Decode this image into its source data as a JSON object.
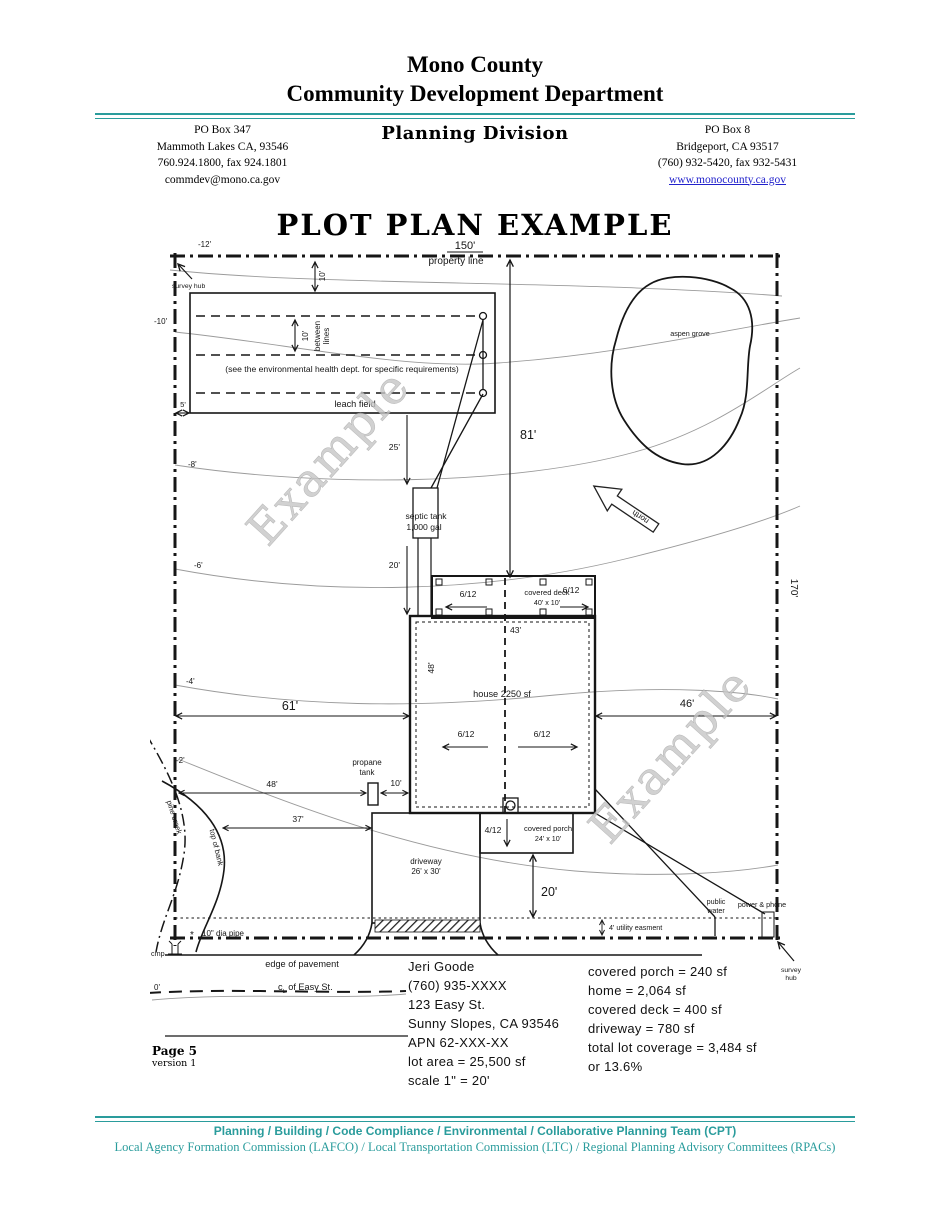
{
  "header": {
    "org_line1": "Mono County",
    "org_line2": "Community Development Department",
    "division": "Planning Division",
    "left_address": [
      "PO Box 347",
      "Mammoth Lakes CA, 93546",
      "760.924.1800, fax 924.1801",
      "commdev@mono.ca.gov"
    ],
    "right_address": [
      "PO Box 8",
      "Bridgeport, CA  93517",
      "(760) 932-5420, fax 932-5431"
    ],
    "website": "www.monocounty.ca.gov"
  },
  "page_title": "PLOT PLAN EXAMPLE",
  "plot": {
    "labels": {
      "survey_hub": "survey hub",
      "survey_1": "survey",
      "survey_2": "hub",
      "dim_150": "150'",
      "property_line": "property line",
      "dim_170": "170'",
      "contour_m12": "-12'",
      "contour_m10": "-10'",
      "contour_m8": "-8'",
      "contour_m6": "-6'",
      "contour_m4": "-4'",
      "contour_m2": "-2'",
      "contour_0": "0'",
      "dim_5": "5'",
      "dim_10_top": "10'",
      "lf_10": "10'",
      "lf_between": "between",
      "lf_lines": "lines",
      "lf_note": "(see the environmental health dept. for specific requirements)",
      "lf_name": "leach field",
      "dim_25": "25'",
      "dim_20_upper": "20'",
      "septic_line1": "septic tank",
      "septic_line2": "1,000 gal",
      "dim_81": "81'",
      "deck_name": "covered deck",
      "deck_size": "40' x 10'",
      "pitch_6": "6/12",
      "dim_43": "43'",
      "dim_48_vert": "48'",
      "house_name": "house 2250 sf",
      "dim_61": "61'",
      "dim_46": "46'",
      "propane_line1": "propane",
      "propane_line2": "tank",
      "dim_48_horiz": "48'",
      "dim_10_propane": "10'",
      "dim_37": "37'",
      "driveway_line1": "driveway",
      "driveway_line2": "26' x 30'",
      "porch_line1": "covered porch",
      "porch_line2": "24' x 10'",
      "pitch_4": "4/12",
      "dim_20_lower": "20'",
      "easement": "4' utility easment",
      "public_line1": "public",
      "public_line2": "water",
      "power_phone": "power & phone",
      "aspen": "aspen grove",
      "north": "north",
      "top_of_bank": "top of bank",
      "pine_creek": "pine creek",
      "pipe": "10\" dia pipe",
      "star": "*",
      "cmp": "cmp",
      "pavement": "edge of pavement",
      "easy_c": "c",
      "easy_sub": "L",
      "easy_rest": " of Easy St.",
      "watermark": "Example"
    }
  },
  "owner_info": {
    "lines": [
      "Jeri Goode",
      "(760) 935-XXXX",
      "123 Easy St.",
      "Sunny Slopes, CA 93546",
      "APN 62-XXX-XX",
      "lot area = 25,500 sf",
      "scale 1\" = 20'"
    ]
  },
  "coverage": {
    "lines": [
      "covered porch = 240 sf",
      "home = 2,064 sf",
      "covered deck = 400 sf",
      "driveway = 780 sf",
      "total lot coverage = 3,484 sf",
      "or 13.6%"
    ]
  },
  "page_note": {
    "page": "Page 5",
    "version": "version 1"
  },
  "footer": {
    "line1": "Planning / Building / Code Compliance / Environmental / Collaborative Planning Team (CPT)",
    "line2": "Local Agency Formation Commission (LAFCO) / Local Transportation Commission (LTC) / Regional Planning Advisory Committees (RPACs)"
  },
  "colors": {
    "teal": "#2a9c9c",
    "link_blue": "#2222cc",
    "watermark": "#c6c6c6"
  }
}
